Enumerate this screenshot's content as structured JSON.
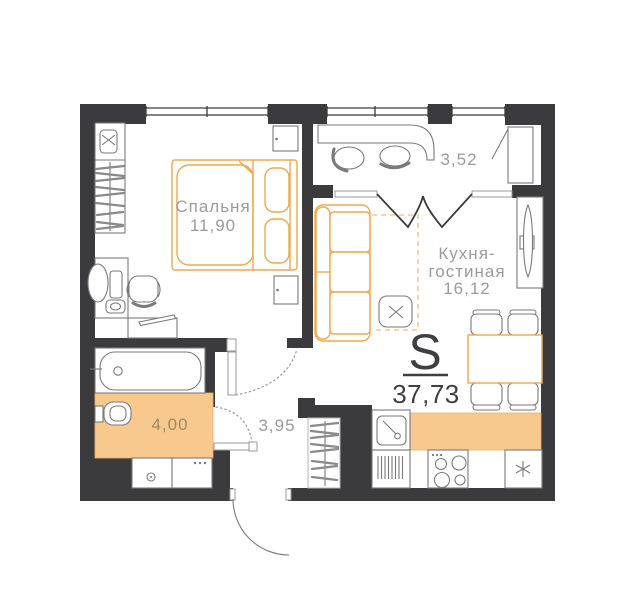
{
  "plan": {
    "rooms": {
      "bedroom": {
        "name": "Спальня",
        "area": "11,90"
      },
      "kitchen_living": {
        "name_line1": "Кухня-",
        "name_line2": "гостиная",
        "area": "16,12"
      },
      "balcony": {
        "area": "3,52"
      },
      "bathroom": {
        "area": "4,00"
      },
      "hallway": {
        "area": "3,95"
      }
    },
    "total": {
      "symbol": "S",
      "area": "37,73"
    },
    "colors": {
      "wall": "#3B3B3D",
      "accent": "#F8C98E",
      "accent_stroke": "#EFA84B",
      "furniture_line": "#7A7A7A",
      "label": "#9B9B9B",
      "total_text": "#3F3F42"
    }
  }
}
